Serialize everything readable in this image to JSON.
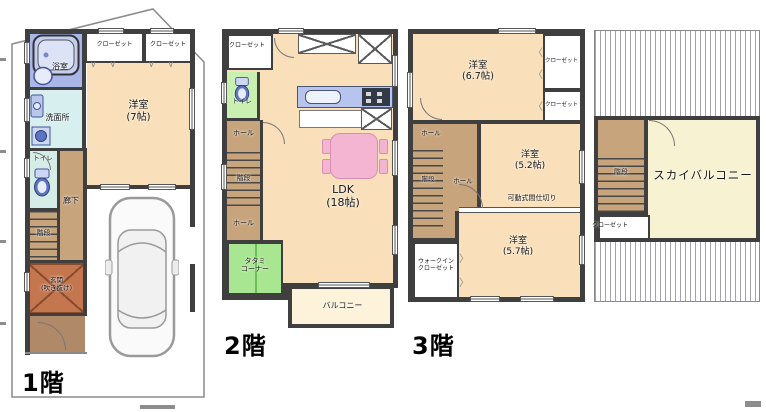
{
  "floors": {
    "f1": {
      "label": "1階",
      "rooms": {
        "bath": "浴室",
        "closet_a": "クローゼット",
        "closet_b": "クローゼット",
        "western": "洋室\n(7帖)",
        "washroom": "洗面所",
        "toilet": "トイレ",
        "corridor": "廊下",
        "stairs": "階段",
        "entrance": "玄関\n(吹き抜け)"
      }
    },
    "f2": {
      "label": "2階",
      "rooms": {
        "closet": "クローゼット",
        "toilet": "トイレ",
        "hall_upper": "ホール",
        "stairs": "階段",
        "hall_lower": "ホール",
        "ldk": "LDK\n(18帖)",
        "tatami": "タタミ\nコーナー",
        "balcony": "バルコニー"
      }
    },
    "f3": {
      "label": "3階",
      "rooms": {
        "western_a": "洋室\n(6.7帖)",
        "closet_a": "クローゼット",
        "closet_b": "クローゼット",
        "hall_upper": "ホール",
        "stairs": "階段",
        "hall_lower": "ホール",
        "western_b": "洋室\n(5.2帖)",
        "partition": "可動式間仕切り",
        "western_c": "洋室\n(5.7帖)",
        "wic": "ウォークイン\nクローゼット"
      }
    },
    "roof": {
      "rooms": {
        "sky_balcony": "スカイバルコニー",
        "stairs": "階段",
        "closet": "クローゼット"
      }
    }
  },
  "icons": {
    "bifold_h": "∨ ∨",
    "bifold_left": "〈",
    "bifold_right": "〉"
  },
  "colors": {
    "wall": "#3f3f3f",
    "room_cream": "#f9e0ba",
    "hall_tan": "#c7a47c",
    "bath_blue": "#a8b6e8",
    "washroom_cyan": "#d8efef",
    "toilet1_pale": "#d5ede6",
    "toilet2_green": "#c9f0b0",
    "tatami_green": "#a9e691",
    "entrance_brown": "#c4764f",
    "porch_brown": "#b08968",
    "kitchen_blue": "#b7c5ee",
    "table_pink": "#f4b5d3",
    "balcony_cream": "#fcf3da",
    "sky_balcony_yellow": "#f6f2d2"
  }
}
